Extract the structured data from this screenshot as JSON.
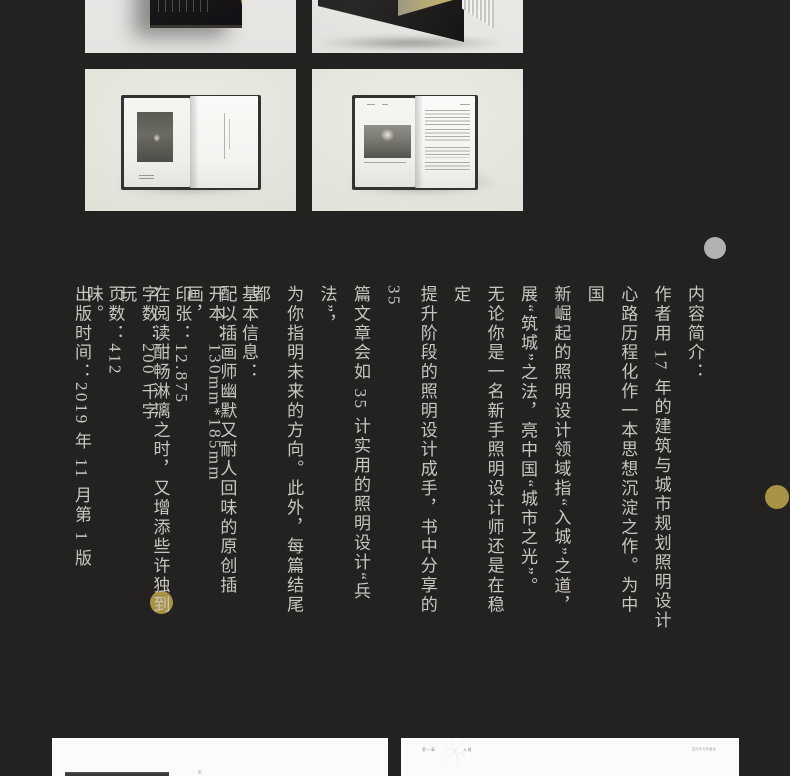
{
  "colors": {
    "background": "#242221",
    "body_text": "#c8c5bf",
    "gold_accent": "#aa9245",
    "gray_dot": "#b2b2b0",
    "top_panel_bg": "#e9e8e6",
    "mid_panel_bg": "#dfe2d9",
    "card_bg": "#fbfbfa"
  },
  "gallery": {
    "image_1": "book-cover-top-view-with-gold-corner",
    "image_2": "standing-book-with-fanned-pages",
    "image_3": "open-book-spread-night-photo-left-page",
    "image_4": "open-book-spread-photo-and-text"
  },
  "intro": {
    "heading": "内容简介：",
    "lines": [
      "作者用 17 年的建筑与城市规划照明设计",
      "心路历程化作一本思想沉淀之作。为中国",
      "新崛起的照明设计领域指“入城”之道，",
      "展“筑城”之法，亮中国“城市之光”。",
      "无论你是一名新手照明设计师还是在稳定",
      "提升阶段的照明设计成手，书中分享的 35",
      "篇文章会如 35 计实用的照明设计“兵法”，",
      "为你指明未来的方向。此外，每篇结尾都",
      "配以插画师幽默又耐人回味的原创插画，",
      "在阅读酣畅淋漓之时，又增添些许独到玩",
      "味。"
    ]
  },
  "basic_info": {
    "heading": "基本信息：",
    "lines": [
      "开本：130mm*185mm",
      "印张：12.875",
      "字数：200 千字",
      "页数：412",
      "出版时间：2019 年 11 月第 1 版"
    ]
  },
  "bottom_cards": {
    "left": {
      "note_mark": "✳"
    },
    "right": {
      "chapter_no": "第一章",
      "chapter_title": "入城",
      "running_header": "空间与光影规划"
    }
  }
}
